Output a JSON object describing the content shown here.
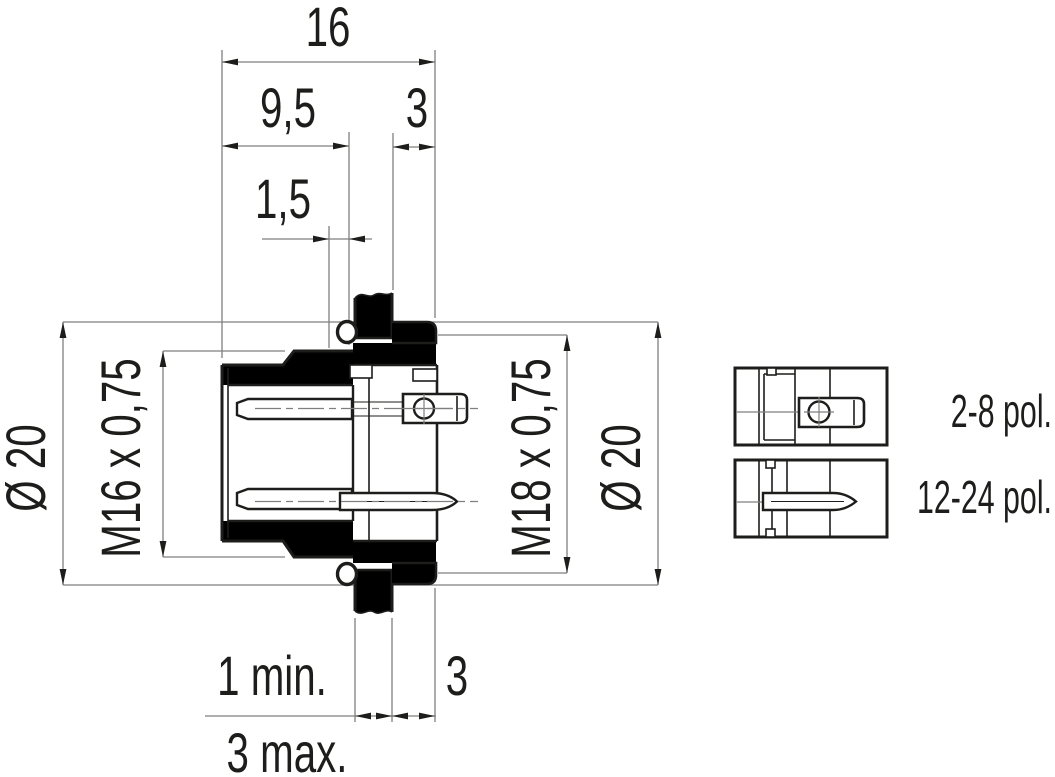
{
  "drawing": {
    "title": "panel-mount male connector cross-section",
    "dimensions": {
      "total_width": "16",
      "front_length": "9,5",
      "rear_protrusion": "3",
      "groove_width": "1,5",
      "flange_diameter": "Ø 20",
      "front_thread": "M16 x 0,75",
      "rear_thread": "M18 x 0,75",
      "rear_nut_diameter": "Ø 20",
      "panel_thickness_min": "1 min.",
      "rear_clearance": "3",
      "panel_thickness_max": "3 max."
    },
    "variants": [
      {
        "label": "2-8 pol."
      },
      {
        "label": "12-24 pol."
      }
    ],
    "colors": {
      "line": "#1d1d1b",
      "dimension": "#7f7f7f",
      "background": "#ffffff"
    }
  }
}
